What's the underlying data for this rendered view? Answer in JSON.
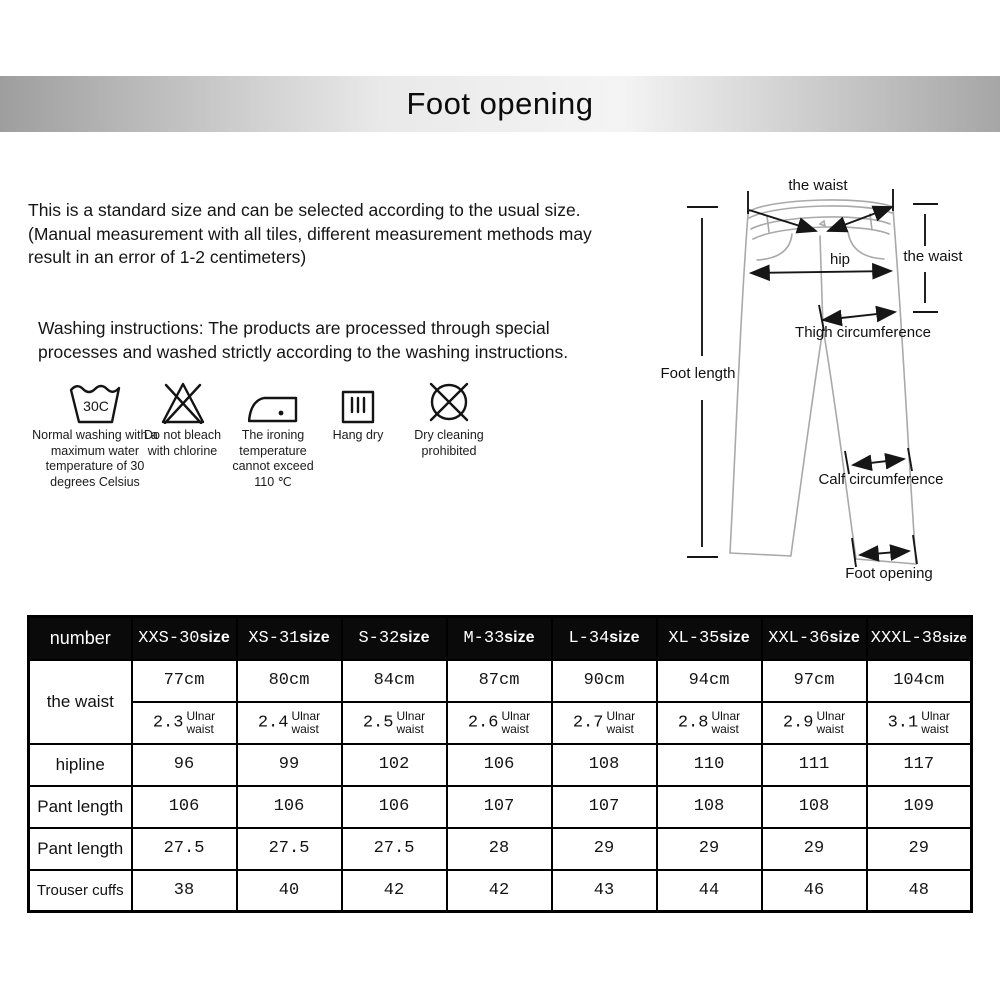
{
  "banner": {
    "title": "Foot opening"
  },
  "intro": {
    "lines": [
      "This is a standard size and can be selected according to the usual size.",
      "(Manual measurement with all tiles, different measurement methods may",
      "result in an error of 1-2 centimeters)"
    ]
  },
  "washing": {
    "intro_lines": [
      "Washing instructions: The products are processed through special",
      "processes and washed strictly according to the washing instructions."
    ],
    "icons": [
      {
        "name": "wash-30-icon",
        "glyph": "30C",
        "label": "Normal washing with a maximum water temperature of 30 degrees Celsius"
      },
      {
        "name": "no-bleach-icon",
        "label": "Do not bleach with chlorine"
      },
      {
        "name": "iron-max-110-icon",
        "label": "The ironing temperature cannot exceed 110 ℃"
      },
      {
        "name": "hang-dry-icon",
        "label": "Hang dry"
      },
      {
        "name": "no-dry-cleaning-icon",
        "label": "Dry cleaning prohibited"
      }
    ]
  },
  "diagram": {
    "labels": {
      "waist_top": "the waist",
      "waist_right": "the waist",
      "hip": "hip",
      "thigh": "Thigh circumference",
      "foot_length": "Foot length",
      "calf": "Calf circumference",
      "foot_opening": "Foot opening"
    }
  },
  "table": {
    "corner_label": "number",
    "size_columns": [
      {
        "code": "XXS-30",
        "suffix": "size"
      },
      {
        "code": "XS-31",
        "suffix": "size"
      },
      {
        "code": "S-32",
        "suffix": "size"
      },
      {
        "code": "M-33",
        "suffix": "size"
      },
      {
        "code": "L-34",
        "suffix": "size"
      },
      {
        "code": "XL-35",
        "suffix": "size"
      },
      {
        "code": "XXL-36",
        "suffix": "size"
      },
      {
        "code": "XXXL-38",
        "suffix": "size"
      }
    ],
    "waist_row": {
      "label": "the waist",
      "cm": [
        "77cm",
        "80cm",
        "84cm",
        "87cm",
        "90cm",
        "94cm",
        "97cm",
        "104cm"
      ],
      "ulnar_values": [
        "2.3",
        "2.4",
        "2.5",
        "2.6",
        "2.7",
        "2.8",
        "2.9",
        "3.1"
      ],
      "ulnar_unit_line1": "Ulnar",
      "ulnar_unit_line2": "waist"
    },
    "rows": [
      {
        "label": "hipline",
        "values": [
          "96",
          "99",
          "102",
          "106",
          "108",
          "110",
          "111",
          "117"
        ]
      },
      {
        "label": "Pant length",
        "values": [
          "106",
          "106",
          "106",
          "107",
          "107",
          "108",
          "108",
          "109"
        ]
      },
      {
        "label": "Pant length",
        "values": [
          "27.5",
          "27.5",
          "27.5",
          "28",
          "29",
          "29",
          "29",
          "29"
        ]
      },
      {
        "label": "Trouser cuffs",
        "values": [
          "38",
          "40",
          "42",
          "42",
          "43",
          "44",
          "46",
          "48"
        ]
      }
    ]
  },
  "colors": {
    "banner_edge": "#a0a0a0",
    "banner_center": "#f2f2f2",
    "table_header_bg": "#0a0a0a",
    "table_header_text": "#ffffff",
    "text": "#111111"
  }
}
